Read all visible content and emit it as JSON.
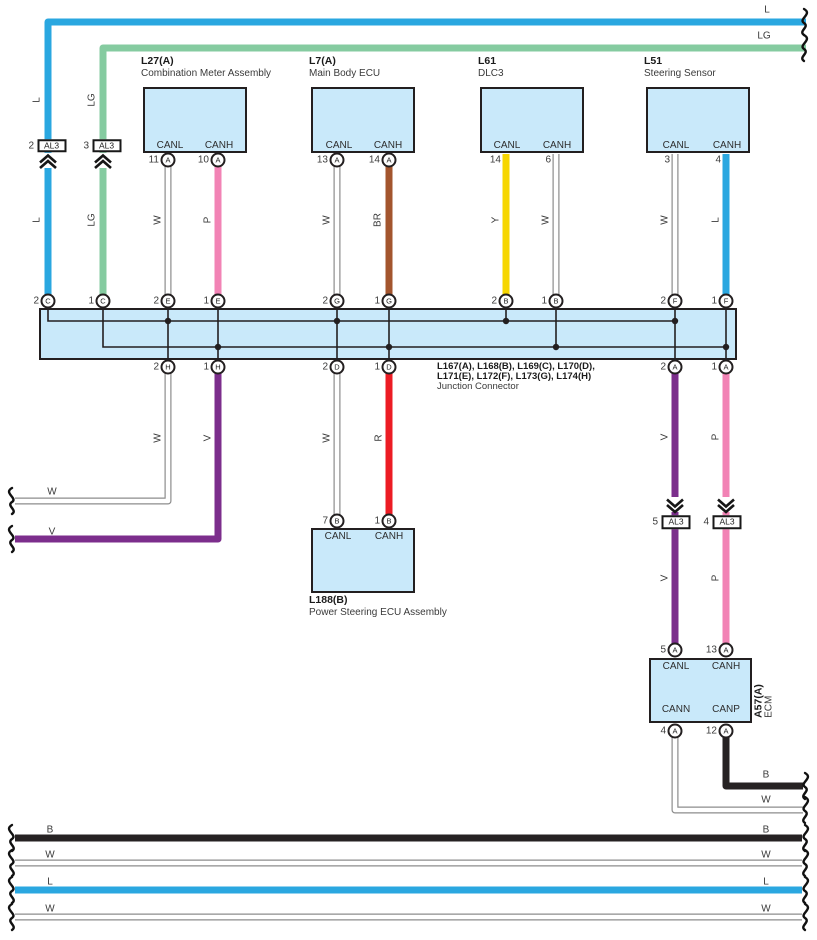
{
  "colors": {
    "blue": "#2AA7E0",
    "light_green": "#85CBA0",
    "pink": "#F283B5",
    "brown": "#A3552E",
    "yellow": "#F6D600",
    "violet": "#7C2E8C",
    "red": "#EC1C24",
    "black": "#262223",
    "white_wire_outline": "#8C8C8C",
    "box_fill": "#C9E9FA",
    "box_border": "#231F20"
  },
  "top_right": {
    "l": "L",
    "lg": "LG"
  },
  "al3_connectors": {
    "top": [
      {
        "num": "2",
        "label": "AL3"
      },
      {
        "num": "3",
        "label": "AL3"
      }
    ],
    "right": [
      {
        "num": "5",
        "label": "AL3"
      },
      {
        "num": "4",
        "label": "AL3"
      }
    ]
  },
  "components": {
    "l27": {
      "code": "L27(A)",
      "name": "Combination Meter Assembly",
      "canl": "CANL",
      "canh": "CANH",
      "pin_canl": {
        "num": "11",
        "letter": "A"
      },
      "pin_canh": {
        "num": "10",
        "letter": "A"
      }
    },
    "l7": {
      "code": "L7(A)",
      "name": "Main Body ECU",
      "canl": "CANL",
      "canh": "CANH",
      "pin_canl": {
        "num": "13",
        "letter": "A"
      },
      "pin_canh": {
        "num": "14",
        "letter": "A"
      }
    },
    "l61": {
      "code": "L61",
      "name": "DLC3",
      "canl": "CANL",
      "canh": "CANH",
      "pin_canl": {
        "num": "14"
      },
      "pin_canh": {
        "num": "6"
      }
    },
    "l51": {
      "code": "L51",
      "name": "Steering Sensor",
      "canl": "CANL",
      "canh": "CANH",
      "pin_canl": {
        "num": "3"
      },
      "pin_canh": {
        "num": "4"
      }
    },
    "l188": {
      "code": "L188(B)",
      "name": "Power Steering ECU Assembly",
      "canl": "CANL",
      "canh": "CANH",
      "pin_canl": {
        "num": "7",
        "letter": "B"
      },
      "pin_canh": {
        "num": "1",
        "letter": "B"
      }
    },
    "ecm": {
      "code": "A57(A)",
      "name": "ECM",
      "canl": "CANL",
      "canh": "CANH",
      "cann": "CANN",
      "canp": "CANP",
      "pin_canl": {
        "num": "5",
        "letter": "A"
      },
      "pin_canh": {
        "num": "13",
        "letter": "A"
      },
      "pin_cann": {
        "num": "4",
        "letter": "A"
      },
      "pin_canp": {
        "num": "12",
        "letter": "A"
      }
    }
  },
  "junction": {
    "label_line1": "L167(A), L168(B), L169(C), L170(D),",
    "label_line2": "L171(E), L172(F), L173(G), L174(H)",
    "label_line3": "Junction Connector",
    "top_pins": [
      {
        "num": "2",
        "letter": "C"
      },
      {
        "num": "1",
        "letter": "C"
      },
      {
        "num": "2",
        "letter": "E"
      },
      {
        "num": "1",
        "letter": "E"
      },
      {
        "num": "2",
        "letter": "G"
      },
      {
        "num": "1",
        "letter": "G"
      },
      {
        "num": "2",
        "letter": "B"
      },
      {
        "num": "1",
        "letter": "B"
      },
      {
        "num": "2",
        "letter": "F"
      },
      {
        "num": "1",
        "letter": "F"
      }
    ],
    "bottom_pins": [
      {
        "num": "2",
        "letter": "H"
      },
      {
        "num": "1",
        "letter": "H"
      },
      {
        "num": "2",
        "letter": "D"
      },
      {
        "num": "1",
        "letter": "D"
      },
      {
        "num": "2",
        "letter": "A"
      },
      {
        "num": "1",
        "letter": "A"
      }
    ]
  },
  "wire_labels": {
    "l_top": "L",
    "lg_top": "LG",
    "l_mid": "L",
    "lg_mid": "LG",
    "w_l27": "W",
    "p_l27": "P",
    "w_l7": "W",
    "br_l7": "BR",
    "y_l61": "Y",
    "w_l61": "W",
    "w_l51": "W",
    "l_l51": "L",
    "w_2h": "W",
    "v_1h": "V",
    "w_2d": "W",
    "r_1d": "R",
    "v_2a": "V",
    "p_1a": "P",
    "v_al3": "V",
    "p_al3": "P",
    "w_exit": "W",
    "v_exit": "V",
    "b_ecm": "B",
    "w_ecm": "W"
  },
  "bottom_bus": [
    {
      "left": "B",
      "right": "B"
    },
    {
      "left": "W",
      "right": "W"
    },
    {
      "left": "L",
      "right": "L"
    },
    {
      "left": "W",
      "right": "W"
    }
  ]
}
